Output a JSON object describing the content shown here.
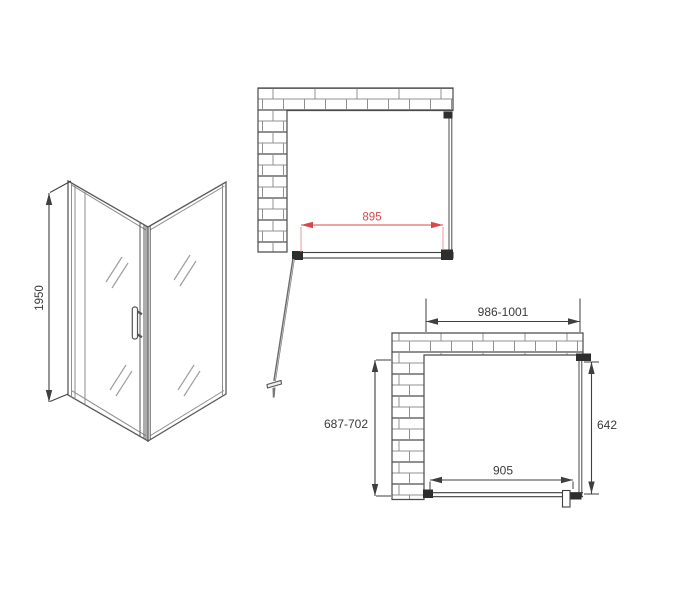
{
  "diagram": {
    "kind": "shower-enclosure-installation-drawing"
  },
  "colors": {
    "background": "#ffffff",
    "line": "#3f3f3f",
    "panel_line": "#5a5a5a",
    "accent_red": "#d9484c",
    "brick_mortar": "#909090",
    "dark_fitting": "#2e2e2e"
  },
  "side_view": {
    "height": "1950"
  },
  "top_plan": {
    "door_width": "895"
  },
  "bottom_plan": {
    "opening_width": "986-1001",
    "opening_depth": "687-702",
    "side_panel_length": "642",
    "door_rail_width": "905"
  }
}
